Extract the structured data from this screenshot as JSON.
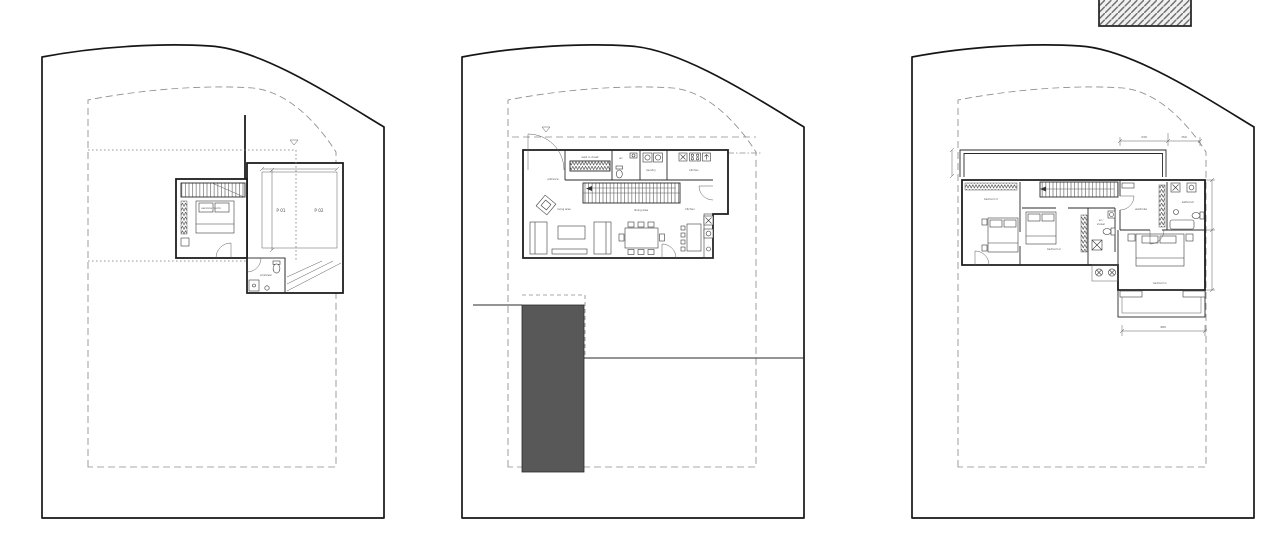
{
  "drawing": {
    "background": "#ffffff",
    "line_color": "#1c1c1c",
    "dash_color": "#8c8c8c",
    "pool_fill": "#585858",
    "parking_label_color": "#a89090"
  },
  "legend": {
    "swatch": "diagonal-hatch"
  },
  "plans": {
    "basement": {
      "labels": {
        "service_room": "service room",
        "wc_shower": "wc/shower",
        "p01": "P 01",
        "p02": "P 02"
      }
    },
    "ground": {
      "labels": {
        "entrance": "entrance",
        "walk_in_closet": "walk in closet",
        "wc": "wc",
        "laundry": "laundry",
        "kitchen": "kitchen",
        "kitchen_2": "kitchen",
        "living": "living area",
        "dining": "dining area"
      }
    },
    "upper": {
      "labels": {
        "bedroom_3": "bedroom 3",
        "bedroom_2": "bedroom 2",
        "bedroom_1": "bedroom 1",
        "wardrobe": "wardrobe",
        "bathroom": "bathroom",
        "wc_shower_line1": "wc /",
        "wc_shower_line2": "shower"
      },
      "dimensions": {
        "top_left": "230",
        "top_right": "150",
        "balcony_width": "480"
      }
    }
  }
}
